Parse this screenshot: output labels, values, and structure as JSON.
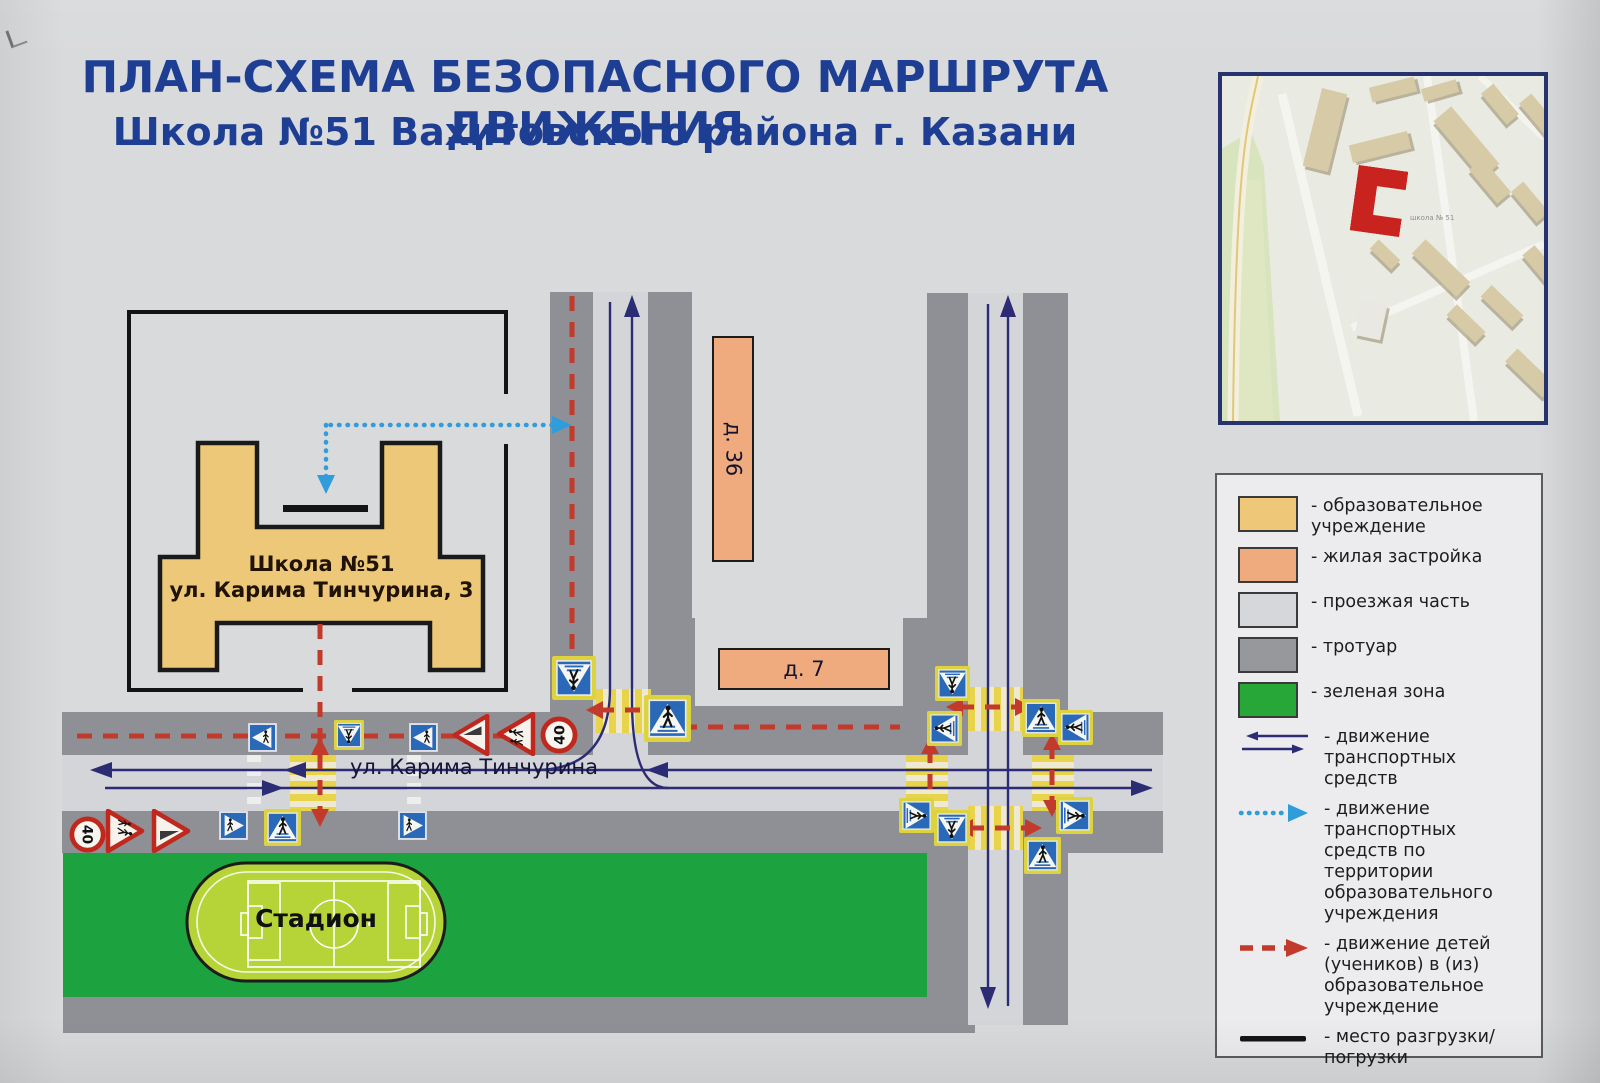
{
  "title": {
    "line1": "ПЛАН-СХЕМА БЕЗОПАСНОГО МАРШРУТА ДВИЖЕНИЯ",
    "line2": "Школа №51  Вахитовского района г. Казани"
  },
  "map_inset": {
    "school_label": "школа № 51"
  },
  "legend": {
    "areas": [
      {
        "label": "- образовательное учреждение",
        "color": "#eec878"
      },
      {
        "label": "- жилая застройка",
        "color": "#efab7e"
      },
      {
        "label": "- проезжая часть",
        "color": "#d6d7db"
      },
      {
        "label": "- тротуар",
        "color": "#97989c"
      },
      {
        "label": "- зеленая зона",
        "color": "#27a737"
      }
    ],
    "routes": [
      {
        "type": "vehicles",
        "label": "- движение транспортных средств"
      },
      {
        "type": "vehicles-territory",
        "label": "- движение транспортных средств по территории образовательного учреждения"
      },
      {
        "type": "children",
        "label": "- движение детей (учеников) в (из) образовательное учреждение"
      },
      {
        "type": "loading",
        "label": "- место разгрузки/погрузки"
      }
    ]
  },
  "diagram": {
    "school_name": "Школа №51",
    "school_address": "ул. Карима Тинчурина, 3",
    "street": "ул. Карима Тинчурина",
    "building_36": "д. 36",
    "building_7": "д. 7",
    "stadium": "Стадион",
    "speed_limit": "40"
  },
  "colors": {
    "title_navy": "#1d3e93",
    "route_children_red": "#c13a2c",
    "route_vehicles_navy": "#2c2c74",
    "route_service_blue": "#2f9cdb",
    "zebra_yellow": "#e7d44b",
    "sign_blue": "#2a69b8",
    "sign_border_yellow": "#ddd33e",
    "green_zone": "#1ca23e",
    "sidewalk_gray": "#8f9095",
    "roadway_gray": "#d3d5d9",
    "school_tan": "#ecc878",
    "residential_salmon": "#efab7e",
    "inset_school_red": "#c92320"
  }
}
